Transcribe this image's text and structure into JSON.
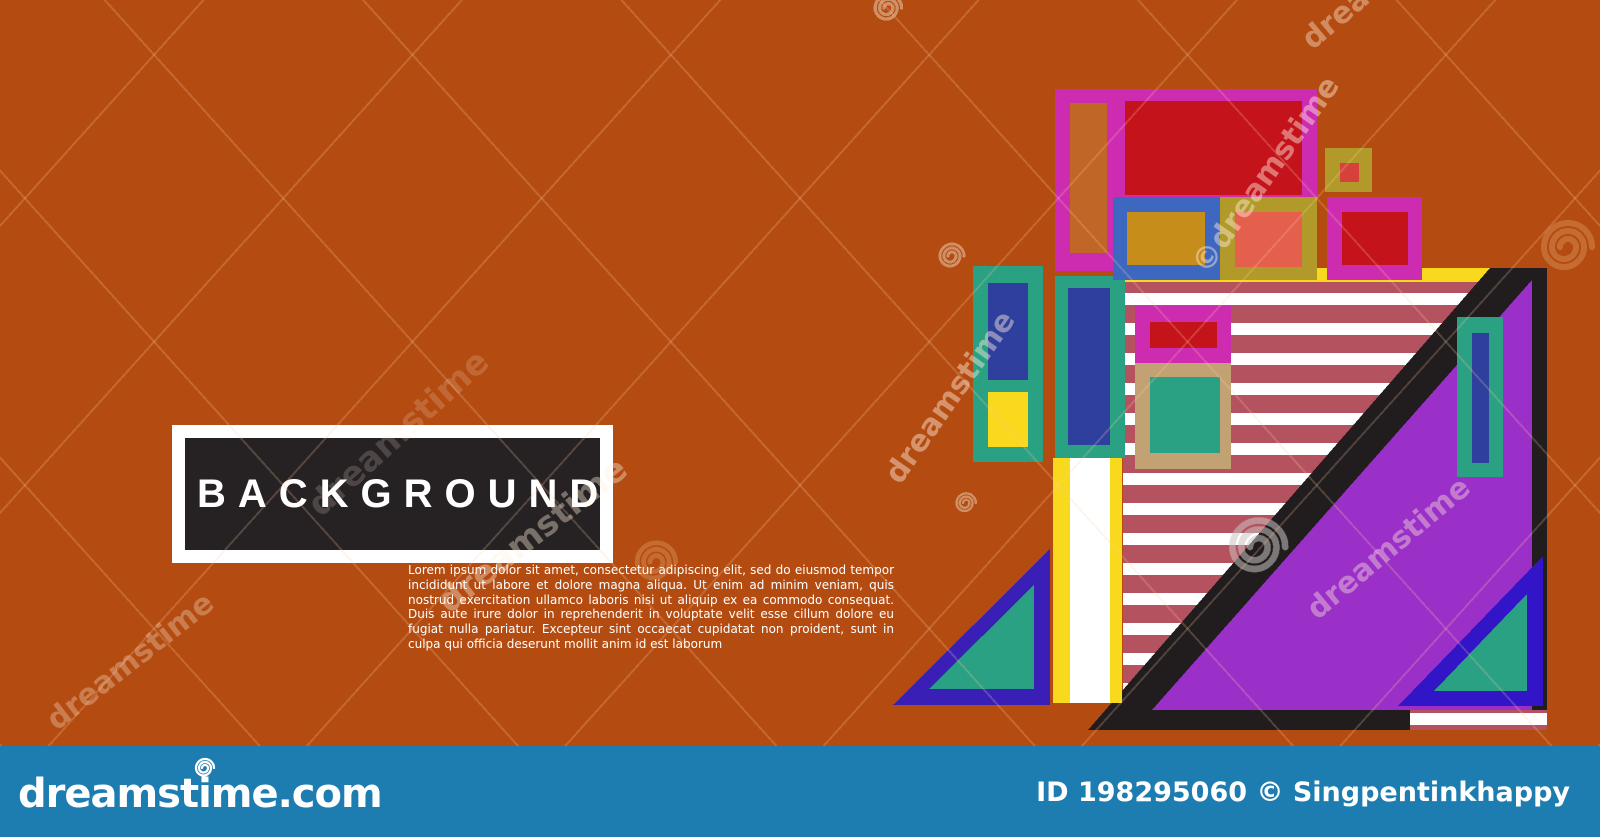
{
  "page": {
    "background_color": "#b44c12"
  },
  "title_box": {
    "label": "BACKGROUND",
    "frame_color": "#ffffff",
    "box_color": "#262223",
    "text_color": "#ffffff"
  },
  "body_text": {
    "paragraph": "Lorem ipsum dolor sit amet, consectetur adipiscing elit, sed do eiusmod tempor incididunt ut labore et dolore magna aliqua. Ut enim ad minim veniam, quis nostrud exercitation ullamco laboris nisi ut aliquip ex ea commodo consequat. Duis aute irure dolor in reprehenderit in voluptate velit esse cillum dolore eu fugiat nulla pariatur. Excepteur sint occaecat cupidatat non proident, sunt in culpa qui officia deserunt mollit anim id est laborum",
    "color": "#ffffff"
  },
  "watermark": {
    "brand_text": "dreamstime",
    "copyright_text": "©dreamstime",
    "spiral_light": "#e8c7ae",
    "spiral_orange": "#d4884f",
    "spiral_grey": "#c9c4c2"
  },
  "footer": {
    "logo_text": "dreamstime.com",
    "credit_text": "ID 198295060 © Singpentinkhappy",
    "bar_color": "#1d7db1",
    "text_color": "#ffffff"
  },
  "artwork": {
    "palette": {
      "magenta": "#cd2bb0",
      "red": "#c5131b",
      "orange_block": "#c06627",
      "blue_frame": "#3e68c0",
      "goldenrod": "#c78d1b",
      "olive": "#b29a2a",
      "salmon": "#e55f4d",
      "brick_small": "#d6413a",
      "teal": "#2aa183",
      "navy": "#2e3f9e",
      "yellow": "#f9d91d",
      "white": "#ffffff",
      "stripe_maroon": "#b5525f",
      "tan": "#c2a273",
      "purple": "#9b30c9",
      "black": "#211d1e",
      "indigo": "#3a1fb6",
      "royal_blue": "#3315c8"
    }
  }
}
